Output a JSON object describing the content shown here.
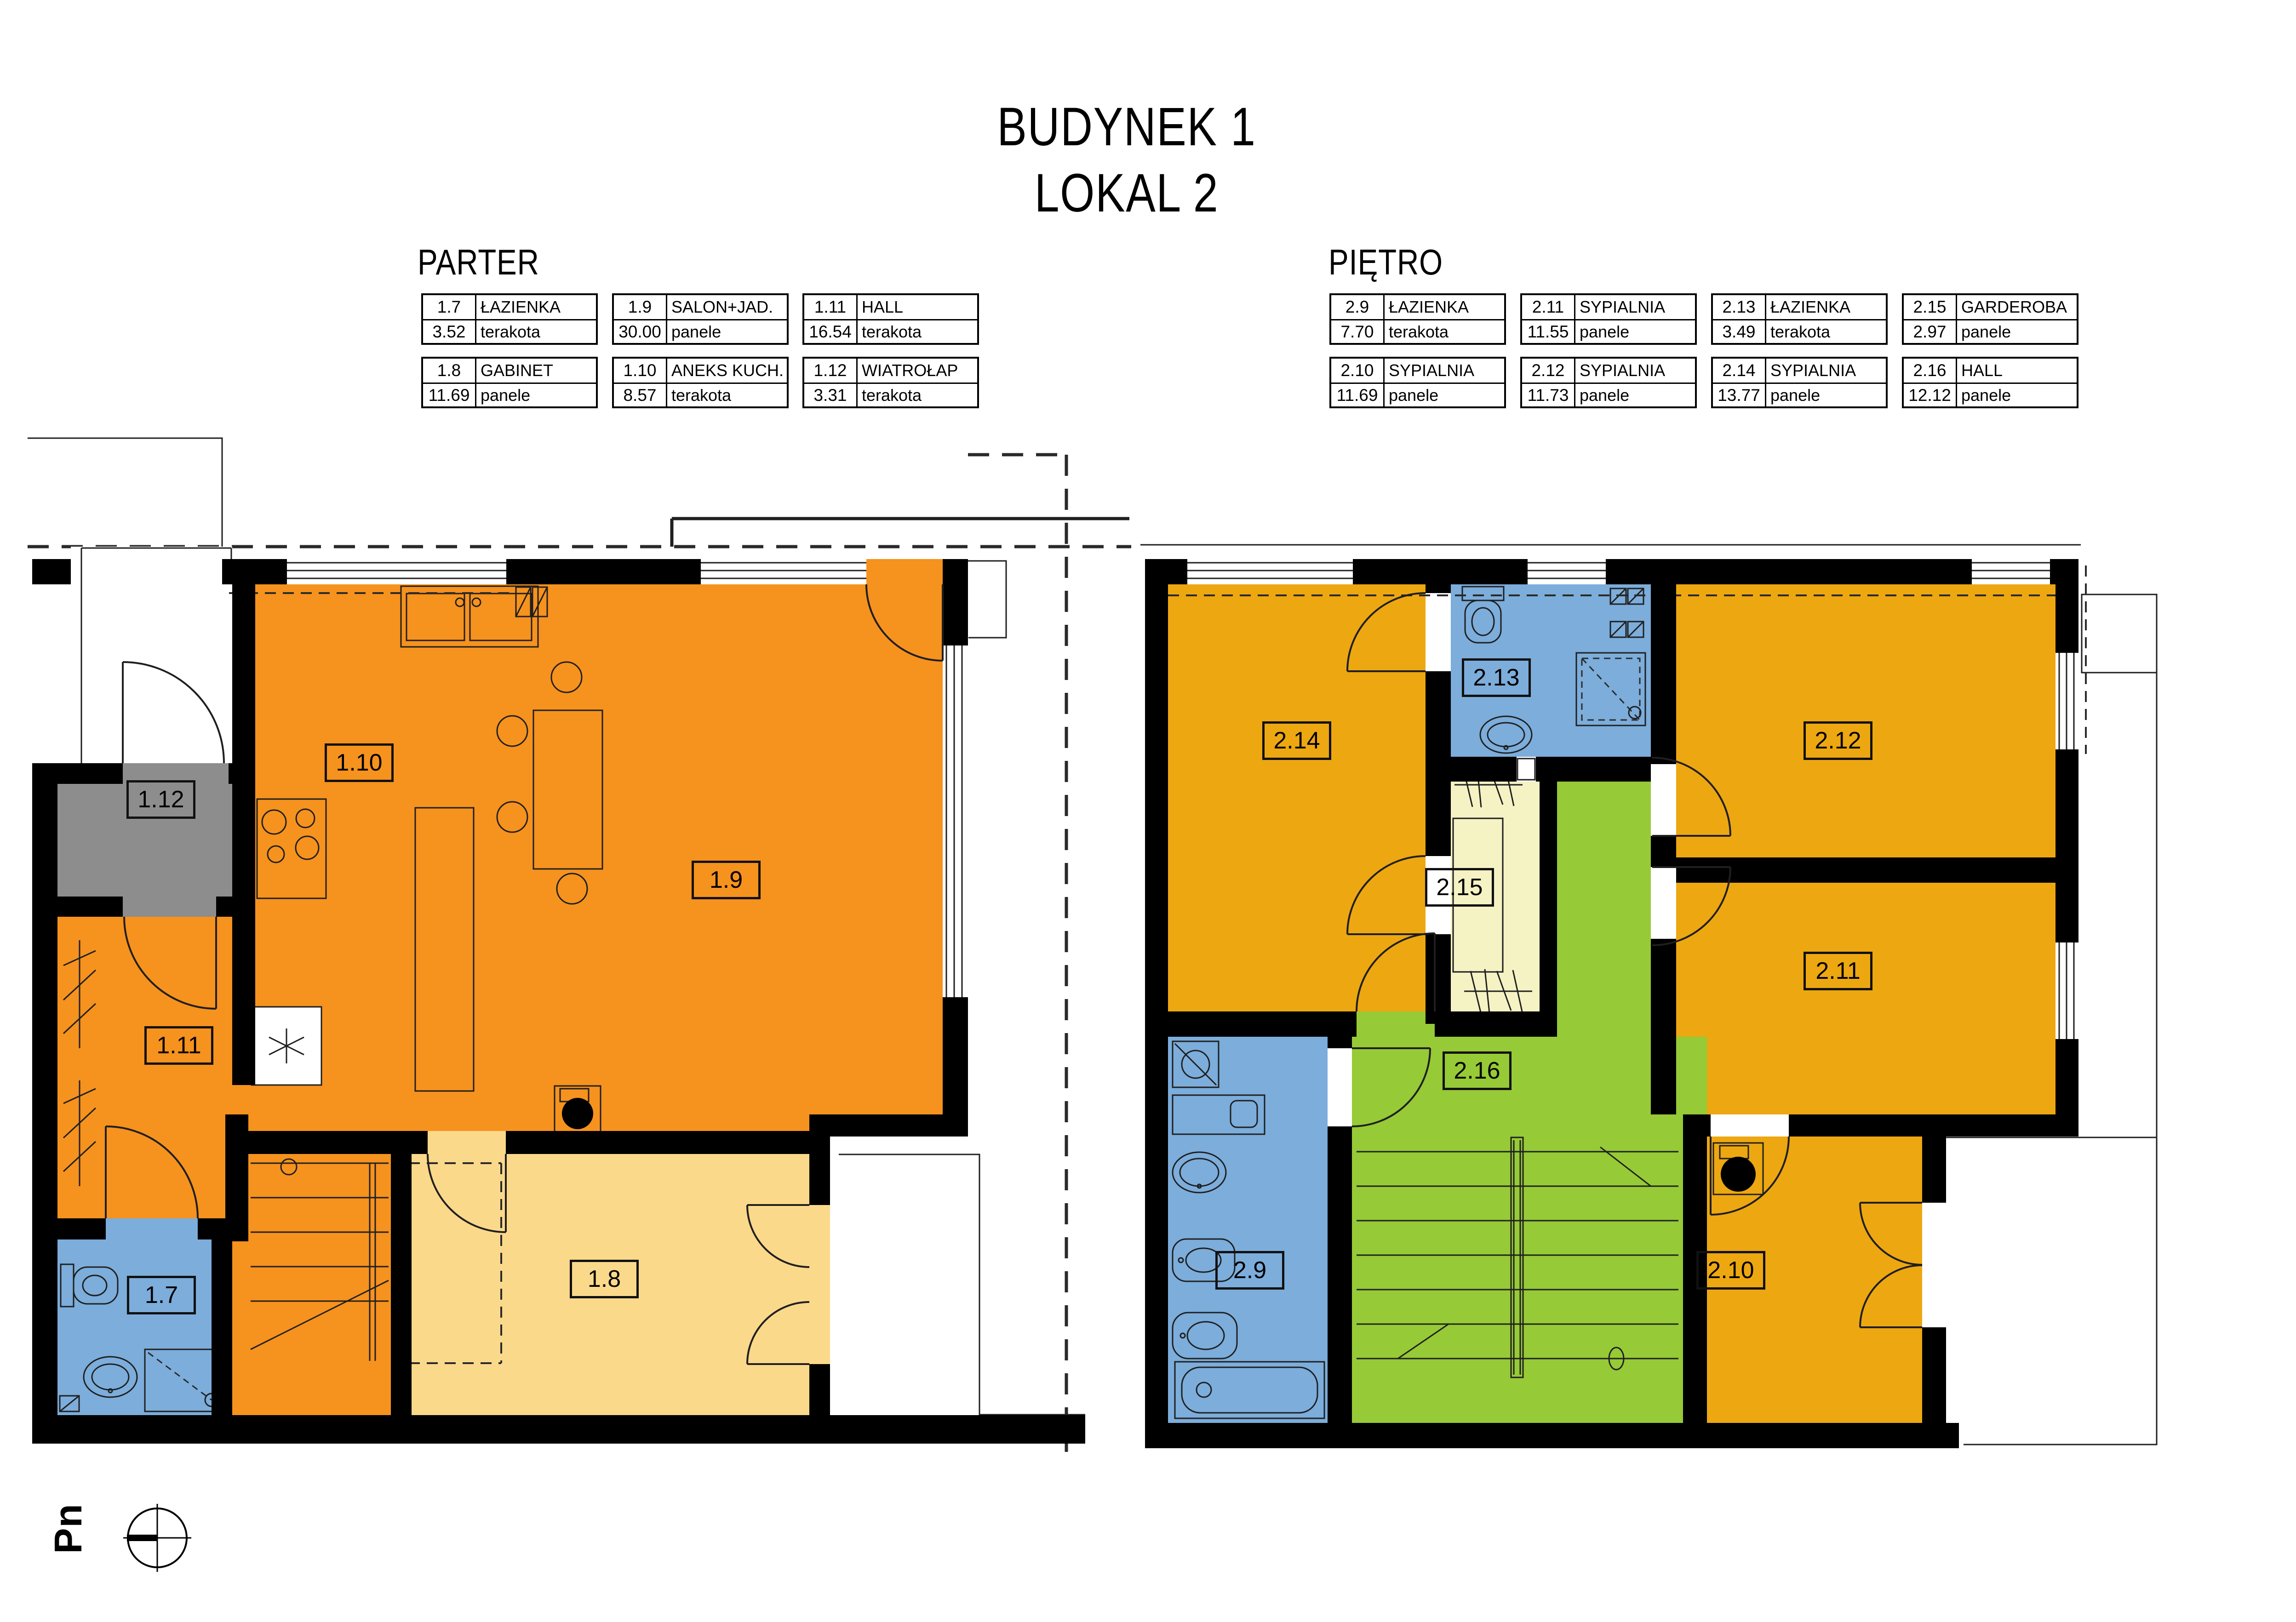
{
  "title": {
    "line1": "BUDYNEK 1",
    "line2": "LOKAL 2"
  },
  "north_indicator": {
    "label": "Pn"
  },
  "floors": {
    "parter": {
      "heading": "PARTER",
      "rooms": [
        {
          "number": "1.7",
          "name": "ŁAZIENKA",
          "area": "3.52",
          "floor_finish": "terakota"
        },
        {
          "number": "1.8",
          "name": "GABINET",
          "area": "11.69",
          "floor_finish": "panele"
        },
        {
          "number": "1.9",
          "name": "SALON+JAD.",
          "area": "30.00",
          "floor_finish": "panele"
        },
        {
          "number": "1.10",
          "name": "ANEKS KUCH.",
          "area": "8.57",
          "floor_finish": "terakota"
        },
        {
          "number": "1.11",
          "name": "HALL",
          "area": "16.54",
          "floor_finish": "terakota"
        },
        {
          "number": "1.12",
          "name": "WIATROŁAP",
          "area": "3.31",
          "floor_finish": "terakota"
        }
      ]
    },
    "pietro": {
      "heading": "PIĘTRO",
      "rooms": [
        {
          "number": "2.9",
          "name": "ŁAZIENKA",
          "area": "7.70",
          "floor_finish": "terakota"
        },
        {
          "number": "2.10",
          "name": "SYPIALNIA",
          "area": "11.69",
          "floor_finish": "panele"
        },
        {
          "number": "2.11",
          "name": "SYPIALNIA",
          "area": "11.55",
          "floor_finish": "panele"
        },
        {
          "number": "2.12",
          "name": "SYPIALNIA",
          "area": "11.73",
          "floor_finish": "panele"
        },
        {
          "number": "2.13",
          "name": "ŁAZIENKA",
          "area": "3.49",
          "floor_finish": "terakota"
        },
        {
          "number": "2.14",
          "name": "SYPIALNIA",
          "area": "13.77",
          "floor_finish": "panele"
        },
        {
          "number": "2.15",
          "name": "GARDEROBA",
          "area": "2.97",
          "floor_finish": "panele"
        },
        {
          "number": "2.16",
          "name": "HALL",
          "area": "12.12",
          "floor_finish": "panele"
        }
      ]
    }
  },
  "colors": {
    "wall": "#000000",
    "parter_main": "#F6921E",
    "parter_gabinet": "#FBD98B",
    "bath_blue": "#7CADDB",
    "entry_gray": "#8D8D8D",
    "pietro_bedroom": "#EDA711",
    "pietro_hall": "#96CA36",
    "pietro_garderoba": "#F5F2C4"
  }
}
